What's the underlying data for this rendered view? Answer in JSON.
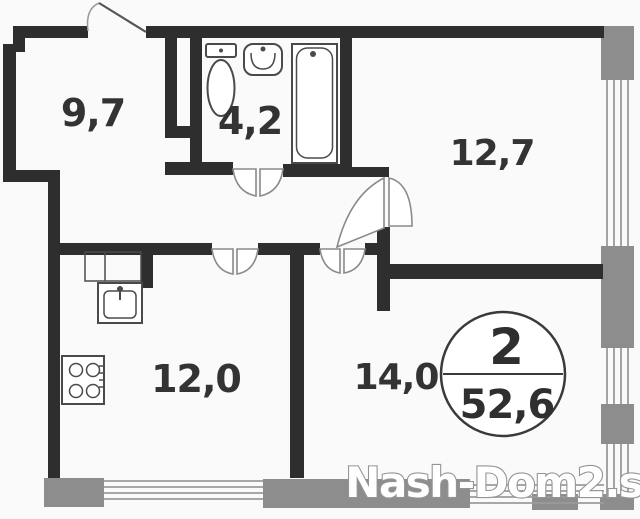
{
  "plan": {
    "rooms": {
      "hall": "9,7",
      "bathroom": "4,2",
      "bedroom": "12,7",
      "kitchen": "12,0",
      "living": "14,0"
    },
    "badge": {
      "room_count": "2",
      "total_area": "52,6"
    },
    "watermark": "Nash-Dom2.su"
  },
  "colors": {
    "wall": "#2e2e2e",
    "window_pier": "#8d8d8d",
    "glazing": "#9b9b9b",
    "fixture": "#4a4a4a",
    "label": "#333333",
    "watermark_fill": "#ffffff",
    "watermark_outline": "#949494",
    "background": "#fafafa"
  }
}
